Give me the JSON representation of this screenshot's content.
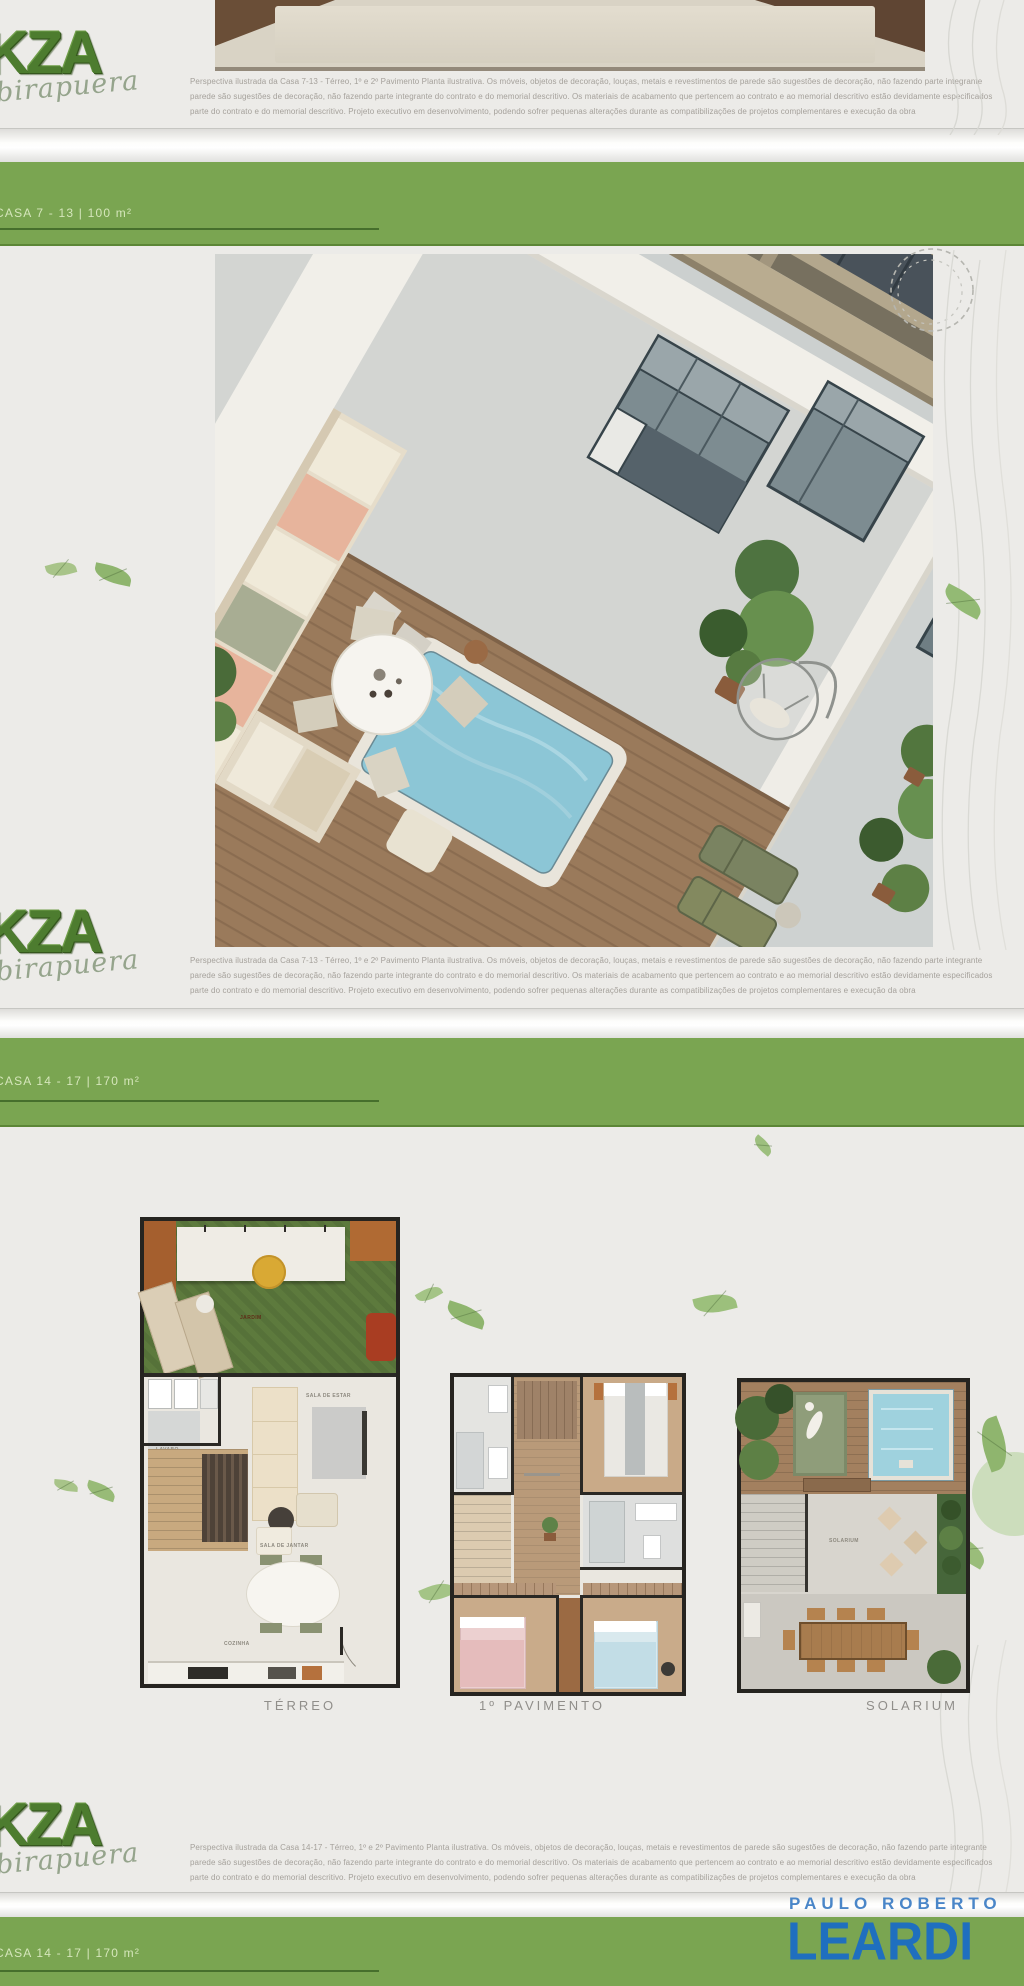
{
  "brand": {
    "kza": "KZA",
    "script": "ibirapuera"
  },
  "bands": {
    "b1": "CASA 7 - 13   |   100 m²",
    "b2": "CASA 14 - 17   |   170 m²",
    "b3": "CASA 14 - 17   |   170 m²"
  },
  "disclaimer_top": {
    "l1": "Perspectiva ilustrada da Casa 7-13 - Térreo, 1º e 2º Pavimento Planta ilustrativa. Os móveis, objetos de decoração, louças, metais e revestimentos de parede são sugestões de decoração, não fazendo parte integrante",
    "l2": "parede são sugestões de decoração, não fazendo parte integrante do contrato e do memorial descritivo. Os materiais de acabamento que pertencem ao contrato e ao memorial descritivo estão devidamente especificados",
    "l3": "parte do contrato e do memorial descritivo. Projeto executivo em desenvolvimento, podendo sofrer pequenas alterações durante as compatibilizações de projetos complementares e execução da obra"
  },
  "disclaimer_mid": {
    "l1": "Perspectiva ilustrada da Casa 7-13 - Térreo, 1º e 2º Pavimento Planta ilustrativa. Os móveis, objetos de decoração, louças, metais e revestimentos de parede são sugestões de decoração, não fazendo parte integrante",
    "l2": "parede são sugestões de decoração, não fazendo parte integrante do contrato e do memorial descritivo. Os materiais de acabamento que pertencem ao contrato e ao memorial descritivo estão devidamente especificados",
    "l3": "parte do contrato e do memorial descritivo. Projeto executivo em desenvolvimento, podendo sofrer pequenas alterações durante as compatibilizações de projetos complementares e execução da obra"
  },
  "disclaimer_bottom": {
    "l1": "Perspectiva ilustrada da Casa 14-17 - Térreo, 1º e 2º Pavimento Planta ilustrativa. Os móveis, objetos de decoração, louças, metais e revestimentos de parede são sugestões de decoração, não fazendo parte integrante",
    "l2": "parede são sugestões de decoração, não fazendo parte integrante do contrato e do memorial descritivo. Os materiais de acabamento que pertencem ao contrato e ao memorial descritivo estão devidamente especificados",
    "l3": "parte do contrato e do memorial descritivo. Projeto executivo em desenvolvimento, podendo sofrer pequenas alterações durante as compatibilizações de projetos complementares e execução da obra"
  },
  "plans": {
    "terreo": {
      "label": "TÉRREO",
      "garden": "JARDIM",
      "sala_estar": "SALA DE ESTAR",
      "lavabo": "LAVABO",
      "sala_jantar": "SALA DE JANTAR",
      "cozinha": "COZINHA"
    },
    "pav": {
      "label": "1º PAVIMENTO"
    },
    "sol": {
      "label": "SOLARIUM",
      "deck": "SOLARIUM"
    }
  },
  "realtor": {
    "top": "PAULO ROBERTO",
    "name": "LEARDI"
  },
  "colors": {
    "band_green": "#7aa551",
    "underline_green": "#466f2c",
    "logo_green": "#4d7c2f",
    "leardi_blue": "#1f6fbf",
    "leardi_light_blue": "#4a86c8",
    "lawn_green": "#5d7a3d",
    "pool_blue": "#8cc6d6",
    "deck_wood": "#9a7a5b"
  }
}
